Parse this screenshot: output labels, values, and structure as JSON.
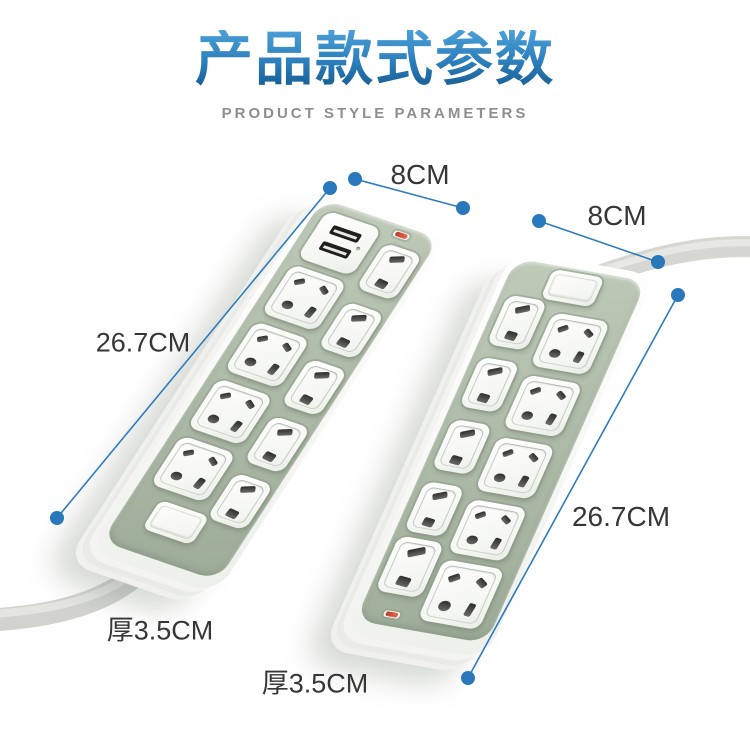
{
  "header": {
    "title": "产品款式参数",
    "subtitle": "PRODUCT STYLE PARAMETERS"
  },
  "dimensions": {
    "left_strip": {
      "width": "8CM",
      "length": "26.7CM",
      "thickness": "厚3.5CM"
    },
    "right_strip": {
      "width": "8CM",
      "length": "26.7CM",
      "thickness": "厚3.5CM"
    }
  },
  "products": {
    "left_strip": {
      "usb_ports": 2,
      "universal_sockets": 4,
      "two_pin_sockets": 5,
      "switches": 1,
      "indicator_lights": 1
    },
    "right_strip": {
      "usb_ports": 0,
      "universal_sockets": 5,
      "two_pin_sockets": 5,
      "switches": 1,
      "indicator_lights": 1
    }
  },
  "colors": {
    "accent_blue": "#2e7cbe",
    "title_gradient_top": "#4ba0da",
    "title_gradient_bottom": "#15598f",
    "subtitle_gray": "#8e8e8e",
    "label_text": "#363636",
    "faceplate_green": "#aebbaa",
    "body_white": "#ffffff",
    "cord_gray": "#d4d5d1",
    "led_red": "#c23a2a"
  }
}
